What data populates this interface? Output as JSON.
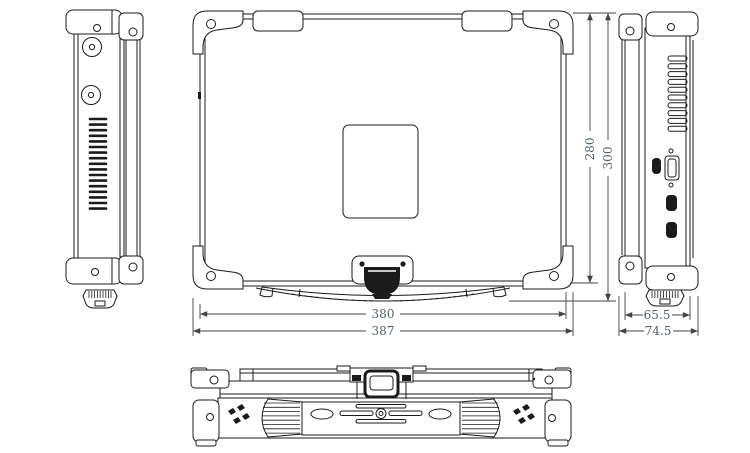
{
  "drawing": {
    "background_color": "#ffffff",
    "line_color": "#1b1b1b",
    "dim_line_color": "#3f4447",
    "dim_text_color": "#51606c",
    "dimensions": {
      "top_width": "380",
      "overall_width": "387",
      "top_depth": "280",
      "overall_depth": "300",
      "side_thickness": "65.5",
      "overall_thickness": "74.5"
    }
  }
}
